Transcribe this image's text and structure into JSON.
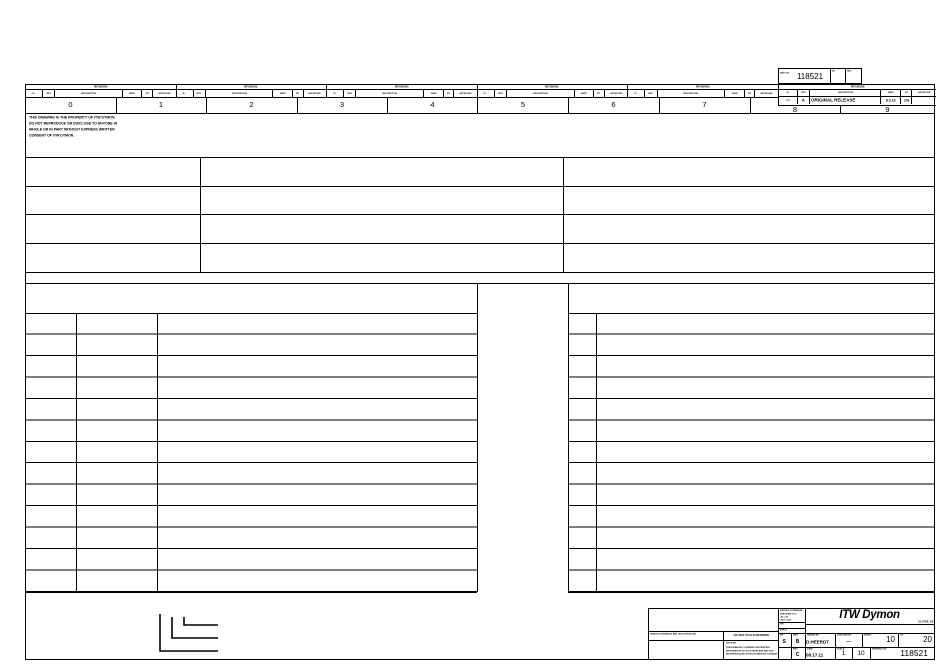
{
  "dwg_box": {
    "label": "DWG NO.",
    "number": "118521",
    "mini1": "SH",
    "mini2": "REV"
  },
  "revisions": {
    "title": "REVISIONS",
    "headers": {
      "zone": "ZL.",
      "rev": "REV",
      "description": "DESCRIPTION",
      "date": "DATE",
      "by": "BY",
      "approved": "APPROVED"
    },
    "entry": {
      "zone": "****",
      "rev": "A",
      "description": "ORIGINAL RELEASE",
      "date": "8.3.13",
      "by": "DS",
      "approved": ""
    }
  },
  "zones": [
    "0",
    "1",
    "2",
    "3",
    "4",
    "5",
    "6",
    "7",
    "8",
    "9"
  ],
  "notes": [
    "THIS DRAWING IS THE PROPERTY OF ITW DYMON.",
    "DO NOT REPRODUCE OR DISCLOSE TO ANYONE IN",
    "WHOLE OR IN PART WITHOUT EXPRESS WRITTEN",
    "CONSENT OF ITW DYMON."
  ],
  "title_block": {
    "uncontrolled_note": "PRINTED DRAWINGS ARE UNCONTROLLED",
    "do_not_scale": "DO NOT SCALE DRAWING",
    "ref": "REF ASM",
    "fine_print": [
      "THIS DRAWING CONTAINS PROPRIETARY",
      "INFORMATION OF ITW DYMON AND MAY NOT",
      "BE REPRODUCED WITHOUT WRITTEN CONSENT"
    ],
    "tolerance_note": [
      "UNLESS OTHERWISE",
      "SPECIFIED TOL:",
      ".XX ±.01",
      ".XXX ±.005"
    ],
    "sn_label": "S/N",
    "appd_label": "APP'D",
    "cell_s": {
      "label": "DR",
      "value": "S"
    },
    "cell_b": {
      "label": "SIZE",
      "value": "B"
    },
    "cell_c": {
      "label": "REV",
      "value": "C"
    },
    "logo": "ITW Dymon",
    "address": "OLATHE, KS",
    "drawn_by": {
      "label": "DRAWN BY",
      "value": "D.HEERDT"
    },
    "checked_by": {
      "label": "CHECKED BY",
      "value": "—"
    },
    "sheet": {
      "label": "SHEET",
      "value": "10"
    },
    "of": {
      "label": "OF",
      "value": "20"
    },
    "date": {
      "label": "DATE",
      "value": "08.17.11"
    },
    "scale_a": {
      "label": "SCALE",
      "value": "1"
    },
    "scale_b": {
      "label": "",
      "value": "10"
    },
    "drawing_no": {
      "label": "DRAWING NO.",
      "value": "118521"
    }
  }
}
